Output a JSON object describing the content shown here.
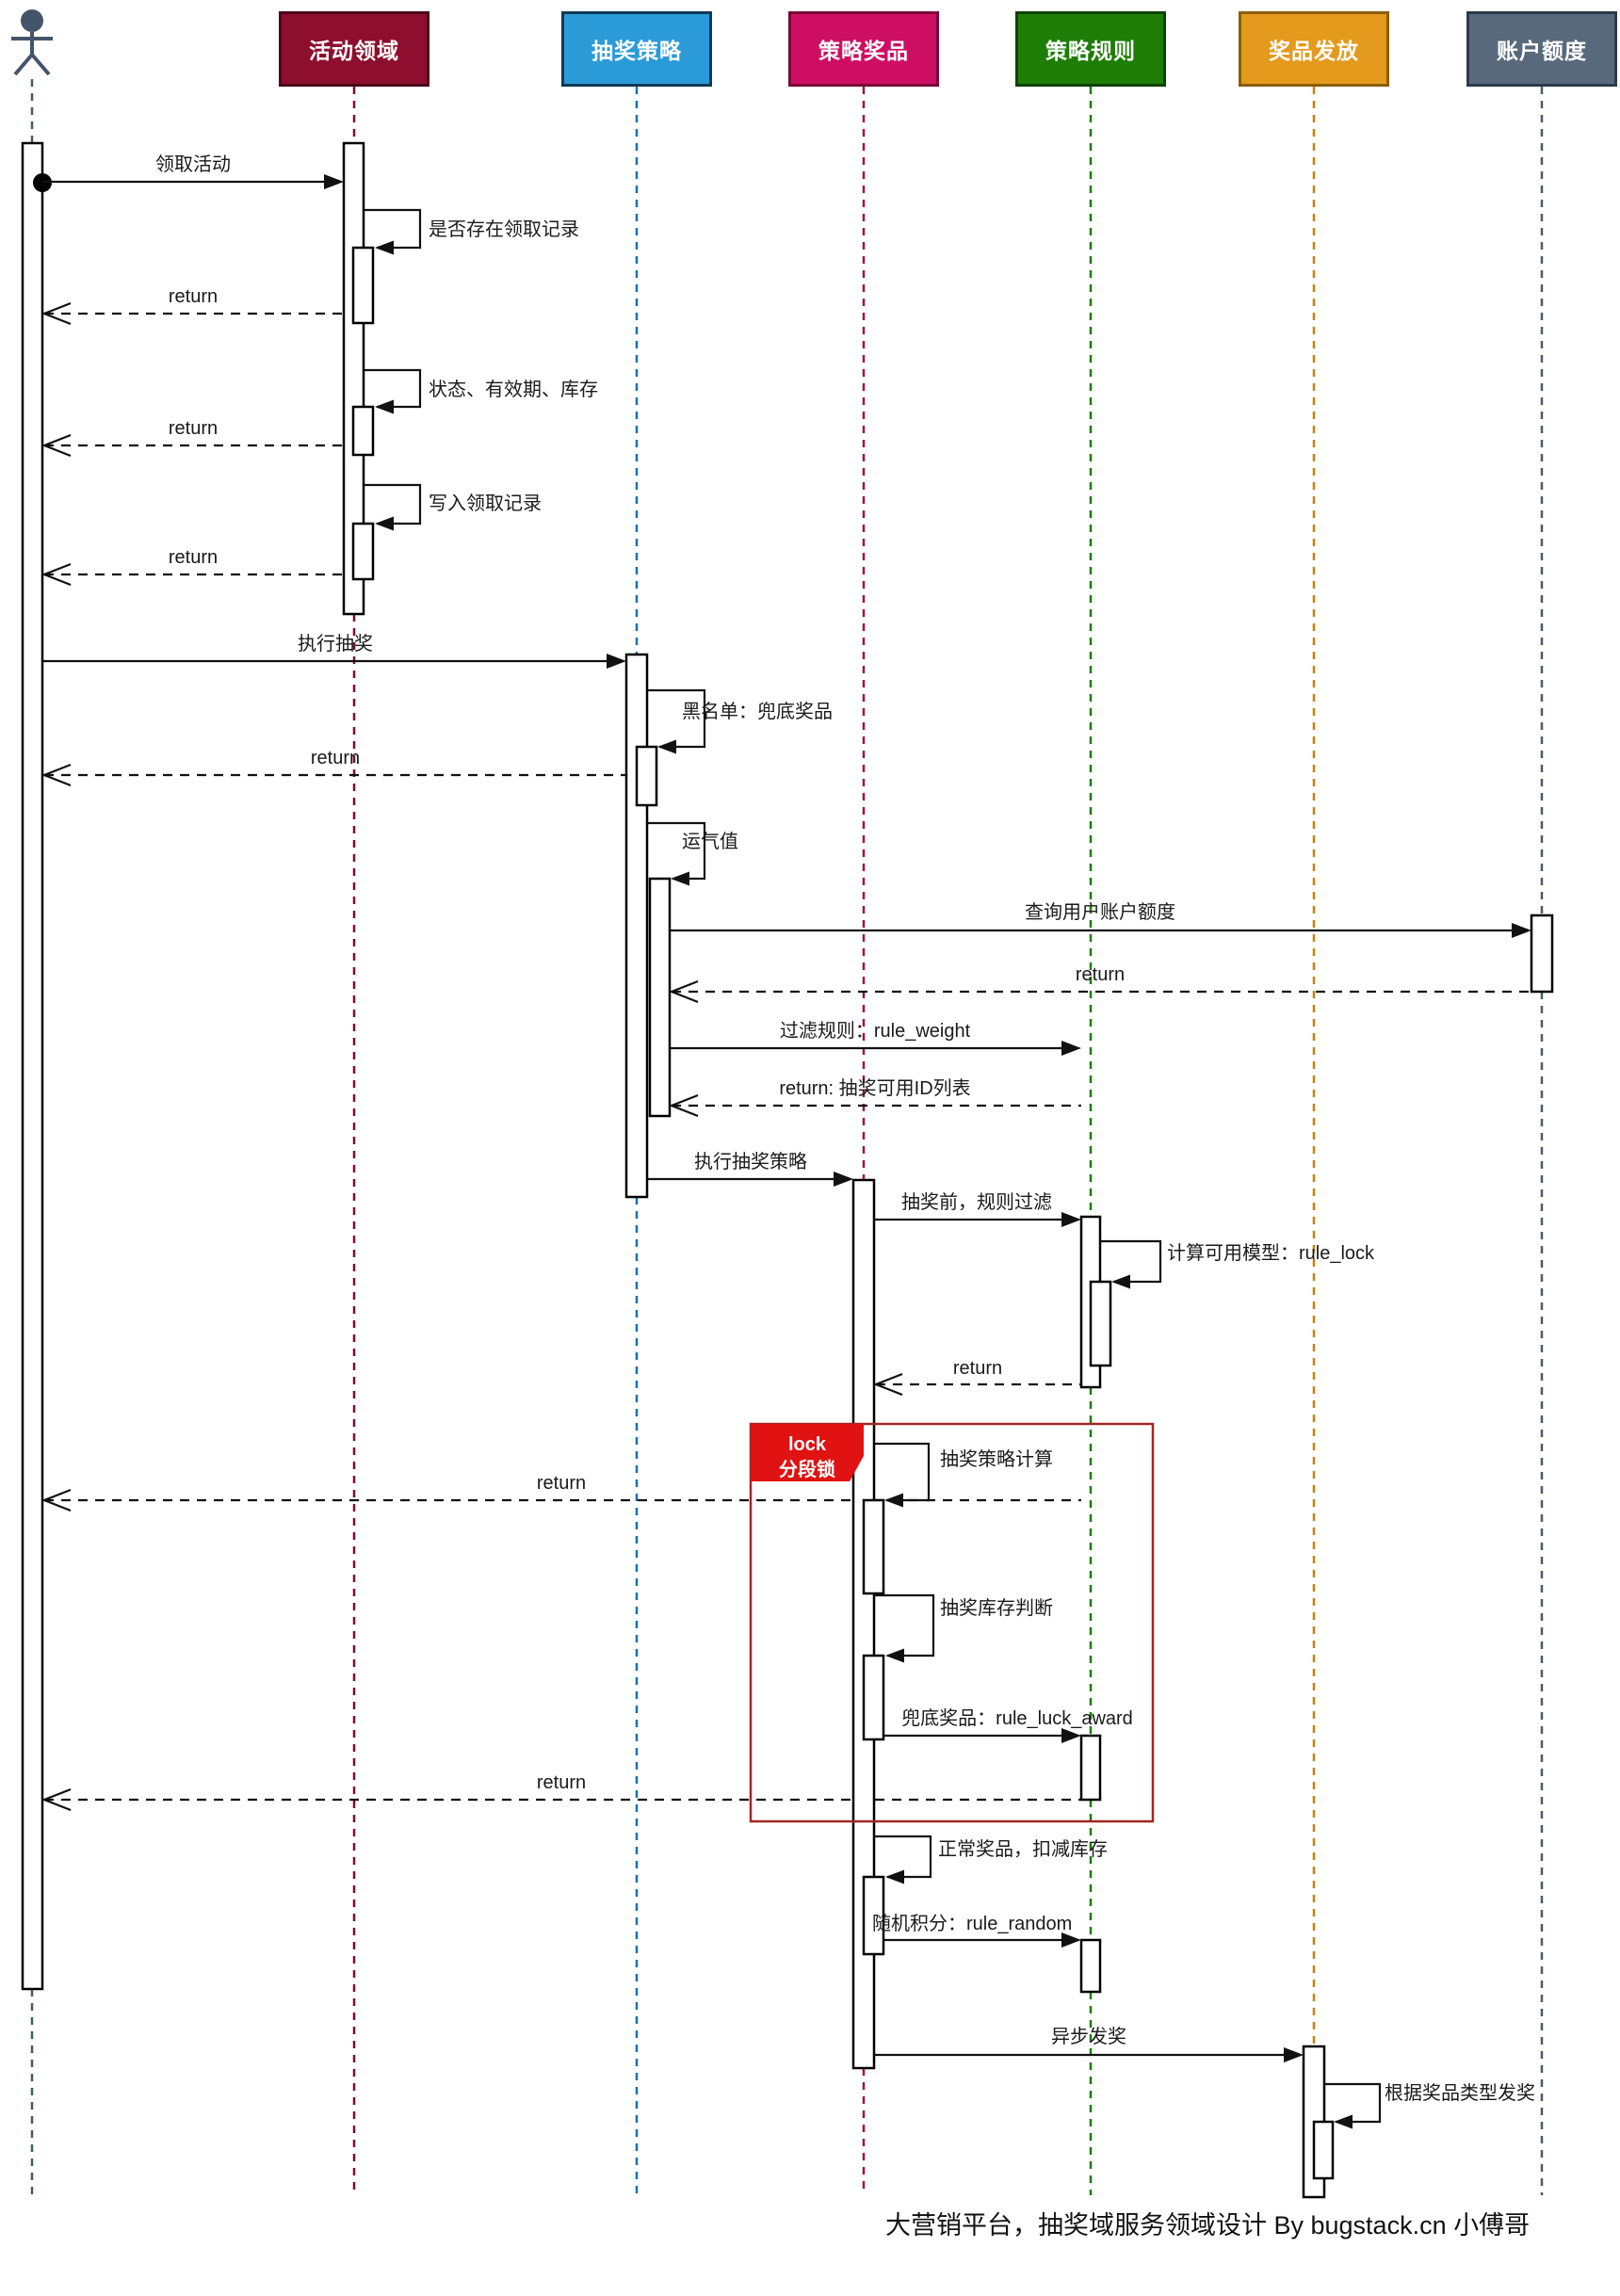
{
  "diagram": {
    "type": "uml-sequence-diagram",
    "footer": "大营销平台，抽奖域服务领域设计 By bugstack.cn 小傅哥",
    "participants": [
      {
        "id": "user",
        "label": "",
        "type": "actor",
        "color": "#44546A",
        "lifeline": "#455A64"
      },
      {
        "id": "activity-domain",
        "label": "活动领域",
        "fill": "#8E0E2F",
        "border": "#4A0818",
        "lifeline": "#7D0C2C"
      },
      {
        "id": "draw-strategy",
        "label": "抽奖策略",
        "fill": "#2B9BD8",
        "border": "#0E3A56",
        "lifeline": "#1A6FB5"
      },
      {
        "id": "strategy-award",
        "label": "策略奖品",
        "fill": "#CE0E63",
        "border": "#7A0838",
        "lifeline": "#A01243"
      },
      {
        "id": "strategy-rule",
        "label": "策略规则",
        "fill": "#1E7D05",
        "border": "#0E4002",
        "lifeline": "#1F7A04"
      },
      {
        "id": "award-send",
        "label": "奖品发放",
        "fill": "#E39A1D",
        "border": "#8A5E08",
        "lifeline": "#C8810F"
      },
      {
        "id": "account-quota",
        "label": "账户额度",
        "fill": "#57697B",
        "border": "#2A3A4A",
        "lifeline": "#4A5A6E"
      }
    ],
    "messages": {
      "claim_activity": "领取活动",
      "check_claim_record": "是否存在领取记录",
      "status_validity_stock": "状态、有效期、库存",
      "write_claim_record": "写入领取记录",
      "execute_draw": "执行抽奖",
      "blacklist_fallback": "黑名单：兜底奖品",
      "luck_value": "运气值",
      "query_account_quota": "查询用户账户额度",
      "filter_rule_weight": "过滤规则：rule_weight",
      "return_label": "return",
      "return_available_ids": "return: 抽奖可用ID列表",
      "execute_draw_strategy": "执行抽奖策略",
      "pre_draw_rule_filter": "抽奖前，规则过滤",
      "compute_model_rule_lock": "计算可用模型：rule_lock",
      "draw_strategy_compute": "抽奖策略计算",
      "draw_stock_check": "抽奖库存判断",
      "fallback_rule_luck_award": "兜底奖品：rule_luck_award",
      "normal_award_deduct": "正常奖品，扣减库存",
      "random_points_rule_random": "随机积分：rule_random",
      "async_send_award": "异步发奖",
      "send_by_award_type": "根据奖品类型发奖"
    },
    "lock_group": {
      "line1": "lock",
      "line2": "分段锁",
      "label_fill": "#E01212",
      "box_border": "#A22626"
    }
  }
}
